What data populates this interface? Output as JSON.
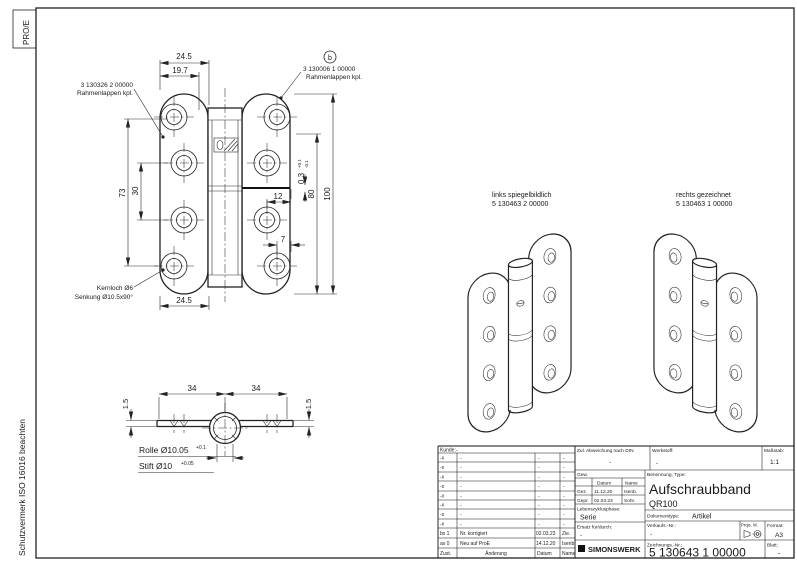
{
  "frame": {
    "proe": "PRO/E",
    "note": "Schutzvermerk ISO 16016 beachten"
  },
  "front": {
    "label_left_no": "3 130326 2 00000",
    "label_left_name": "Rahmenlappen kpl.",
    "label_right_no": "3 130006 1 00000",
    "label_right_name": "Rahmenlappen kpl.",
    "detail_b": "b",
    "kernloch": "Kernloch Ø6",
    "senkung": "Senkung Ø10.5x90°",
    "dim_top": "24.5",
    "dim_top2": "19.7",
    "dim_73": "73",
    "dim_30": "30",
    "dim_100": "100",
    "dim_80": "80",
    "dim_gap": "0.3",
    "dim_gap_tol_up": "+0.1",
    "dim_gap_tol_dn": "-0.1",
    "dim_12": "12",
    "dim_7": "7",
    "dim_bottom": "24.5"
  },
  "section": {
    "dim_34_l": "34",
    "dim_34_r": "34",
    "dim_15_l": "1.5",
    "dim_15_r": "1.5",
    "rolle": "Rolle Ø10.05",
    "rolle_tol": "+0.1",
    "stift": "Stift Ø10",
    "stift_tol": "+0.05"
  },
  "iso": {
    "left_line1": "links spiegelbildlich",
    "left_line2": "5 130463 2 00000",
    "right_line1": "rechts gezeichnet",
    "right_line2": "5 130463 1 00000"
  },
  "tb": {
    "kunde": "Kunde:-",
    "rows": [
      {
        "zust": "-x",
        "aend": "-",
        "datum": "-",
        "name": "-"
      },
      {
        "zust": "-x",
        "aend": "-",
        "datum": "-",
        "name": "-"
      },
      {
        "zust": "-x",
        "aend": "-",
        "datum": "-",
        "name": "-"
      },
      {
        "zust": "-x",
        "aend": "-",
        "datum": "-",
        "name": "-"
      },
      {
        "zust": "-x",
        "aend": "-",
        "datum": "-",
        "name": "-"
      },
      {
        "zust": "-x",
        "aend": "-",
        "datum": "-",
        "name": "-"
      },
      {
        "zust": "-x",
        "aend": "-",
        "datum": "-",
        "name": "-"
      },
      {
        "zust": "-x",
        "aend": "-",
        "datum": "-",
        "name": "-"
      }
    ],
    "rev_b": {
      "zust": "bx 1",
      "aend": "Nr. korrigiert",
      "datum": "02.03.23",
      "name": "Zie."
    },
    "rev_a": {
      "zust": "ax 0",
      "aend": "Neu auf ProE",
      "datum": "14.12.20",
      "name": "Isenb"
    },
    "foot": {
      "zust": "Zust.",
      "aend": "Änderung",
      "datum": "Datum",
      "name": "Name"
    },
    "zul_label": "Zul. Abweichung nach DIN",
    "zul_value": "-",
    "werkstoff_label": "Werkstoff:",
    "werkstoff_value": "-",
    "massstab_label": "Maßstab:",
    "massstab_value": "1:1",
    "gew_label": "Gew.",
    "datum_col": "Datum",
    "name_col": "Name",
    "gez_label": "Gez.",
    "gez_datum": "11.12.20",
    "gez_name": "Isenb.",
    "gepr_label": "Gepr.",
    "gepr_datum": "02.03.23",
    "gepr_name": "Sohr.",
    "leben_label": "Lebenszyklusphase:",
    "leben_value": "Serie",
    "ersatz_label": "Ersatz für/durch:",
    "ersatz_value": "-",
    "logo": "SIMONSWERK",
    "benennung_label": "Benennung, Type:",
    "benennung_value": "Aufschraubband",
    "type_value": "QR100",
    "dok_label": "Dokumenttype:",
    "dok_value": "Artikel",
    "verkaufs_label": "Verkaufs.-Nr.:",
    "verkaufs_value": "-",
    "proj_label": "Proje. M.",
    "format_label": "Format:",
    "format_value": "A3",
    "zeich_label": "Zeichnungs.-Nr.:",
    "zeich_value": "5 130643 1 00000",
    "blatt_label": "Blatt:",
    "blatt_value": "-"
  }
}
